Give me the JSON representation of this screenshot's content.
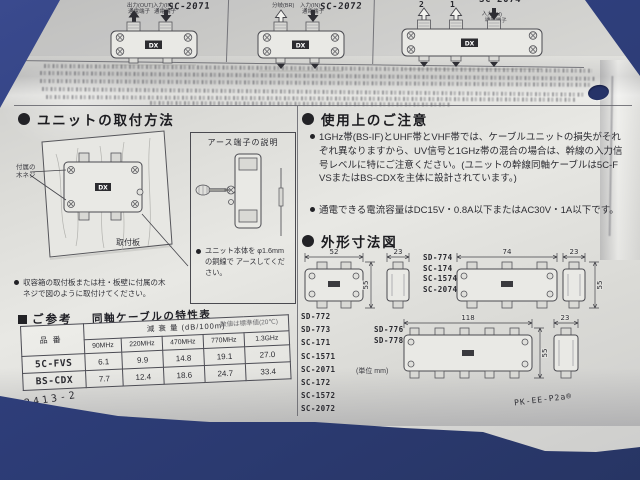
{
  "photo": {
    "background_color": "#2f3f7d",
    "paper_color": "#dcdcd8"
  },
  "top_panels": {
    "dx_logo": "DX",
    "panel1": {
      "model": "SC-2071",
      "label_out": "出力(OUT)",
      "label_out_sub": "通電端子",
      "label_in": "入力(IN)",
      "label_in_sub": "通電端子"
    },
    "panel2": {
      "model": "SC-2072",
      "label_branch": "分岐(BR)",
      "label_in": "入力(IN)",
      "label_in_sub": "通電端子"
    },
    "panel3": {
      "model": "SC-2074",
      "port2": "2",
      "port1": "1",
      "label_in": "入力(IN)",
      "label_in_sub": "通電端子"
    }
  },
  "install": {
    "title": "ユニットの取付方法",
    "screw_label_1": "付属の",
    "screw_label_2": "木ネジ",
    "board_label": "取付板",
    "earth_box_title": "アース端子の説明",
    "earth_note": "ユニット本体を φ1.6mmの銅線で アースしてください。",
    "mount_note": "収容箱の取付板または柱・板壁に付属の木ネジで図のように取付けてください。"
  },
  "caution": {
    "title": "使用上のご注意",
    "item1": "1GHz帯(BS-IF)とUHF帯とVHF帯では、ケーブルユニットの損失がそれぞれ異なりますから、UV信号と1GHz帯の混合の場合は、幹線の入力信号レベルに特にご注意ください。(ユニットの幹線同軸ケーブルは5C-FVSまたはBS-CDXを主体に設計されています。)",
    "item2": "通電できる電流容量はDC15V・0.8A以下またはAC30V・1A以下です。"
  },
  "dimensions": {
    "title": "外形寸法図",
    "unit_note": "(単位 mm)",
    "part_code": "PK-EE-P2a®",
    "fig1": {
      "width": "52",
      "depth": "23",
      "height": "55"
    },
    "fig2": {
      "width": "74",
      "depth": "23",
      "height": "55"
    },
    "fig3": {
      "width": "118",
      "depth": "23",
      "height": "55"
    },
    "models_fig2": [
      "SD-774",
      "SC-174",
      "SC-1574",
      "SC-2074"
    ],
    "models_fig1": [
      "SD-772",
      "SD-773",
      "SC-171",
      "SC-1571",
      "SC-2071",
      "SC-172",
      "SC-1572",
      "SC-2072"
    ],
    "models_fig3": [
      "SD-776",
      "SD-778"
    ]
  },
  "reference": {
    "label": "ご参考",
    "table_title": "同軸ケーブルの特性表",
    "table_note": "数値は標準値(20℃)",
    "col_product": "品番",
    "col_attenuation": "減 衰 量 (dB/100m)",
    "freqs": [
      "90MHz",
      "220MHz",
      "470MHz",
      "770MHz",
      "1.3GHz"
    ],
    "rows": [
      {
        "name": "5C-FVS",
        "values": [
          "6.1",
          "9.9",
          "14.8",
          "19.1",
          "27.0"
        ]
      },
      {
        "name": "BS-CDX",
        "values": [
          "7.7",
          "12.4",
          "18.6",
          "24.7",
          "33.4"
        ]
      }
    ],
    "doc_number": "2413-2"
  }
}
